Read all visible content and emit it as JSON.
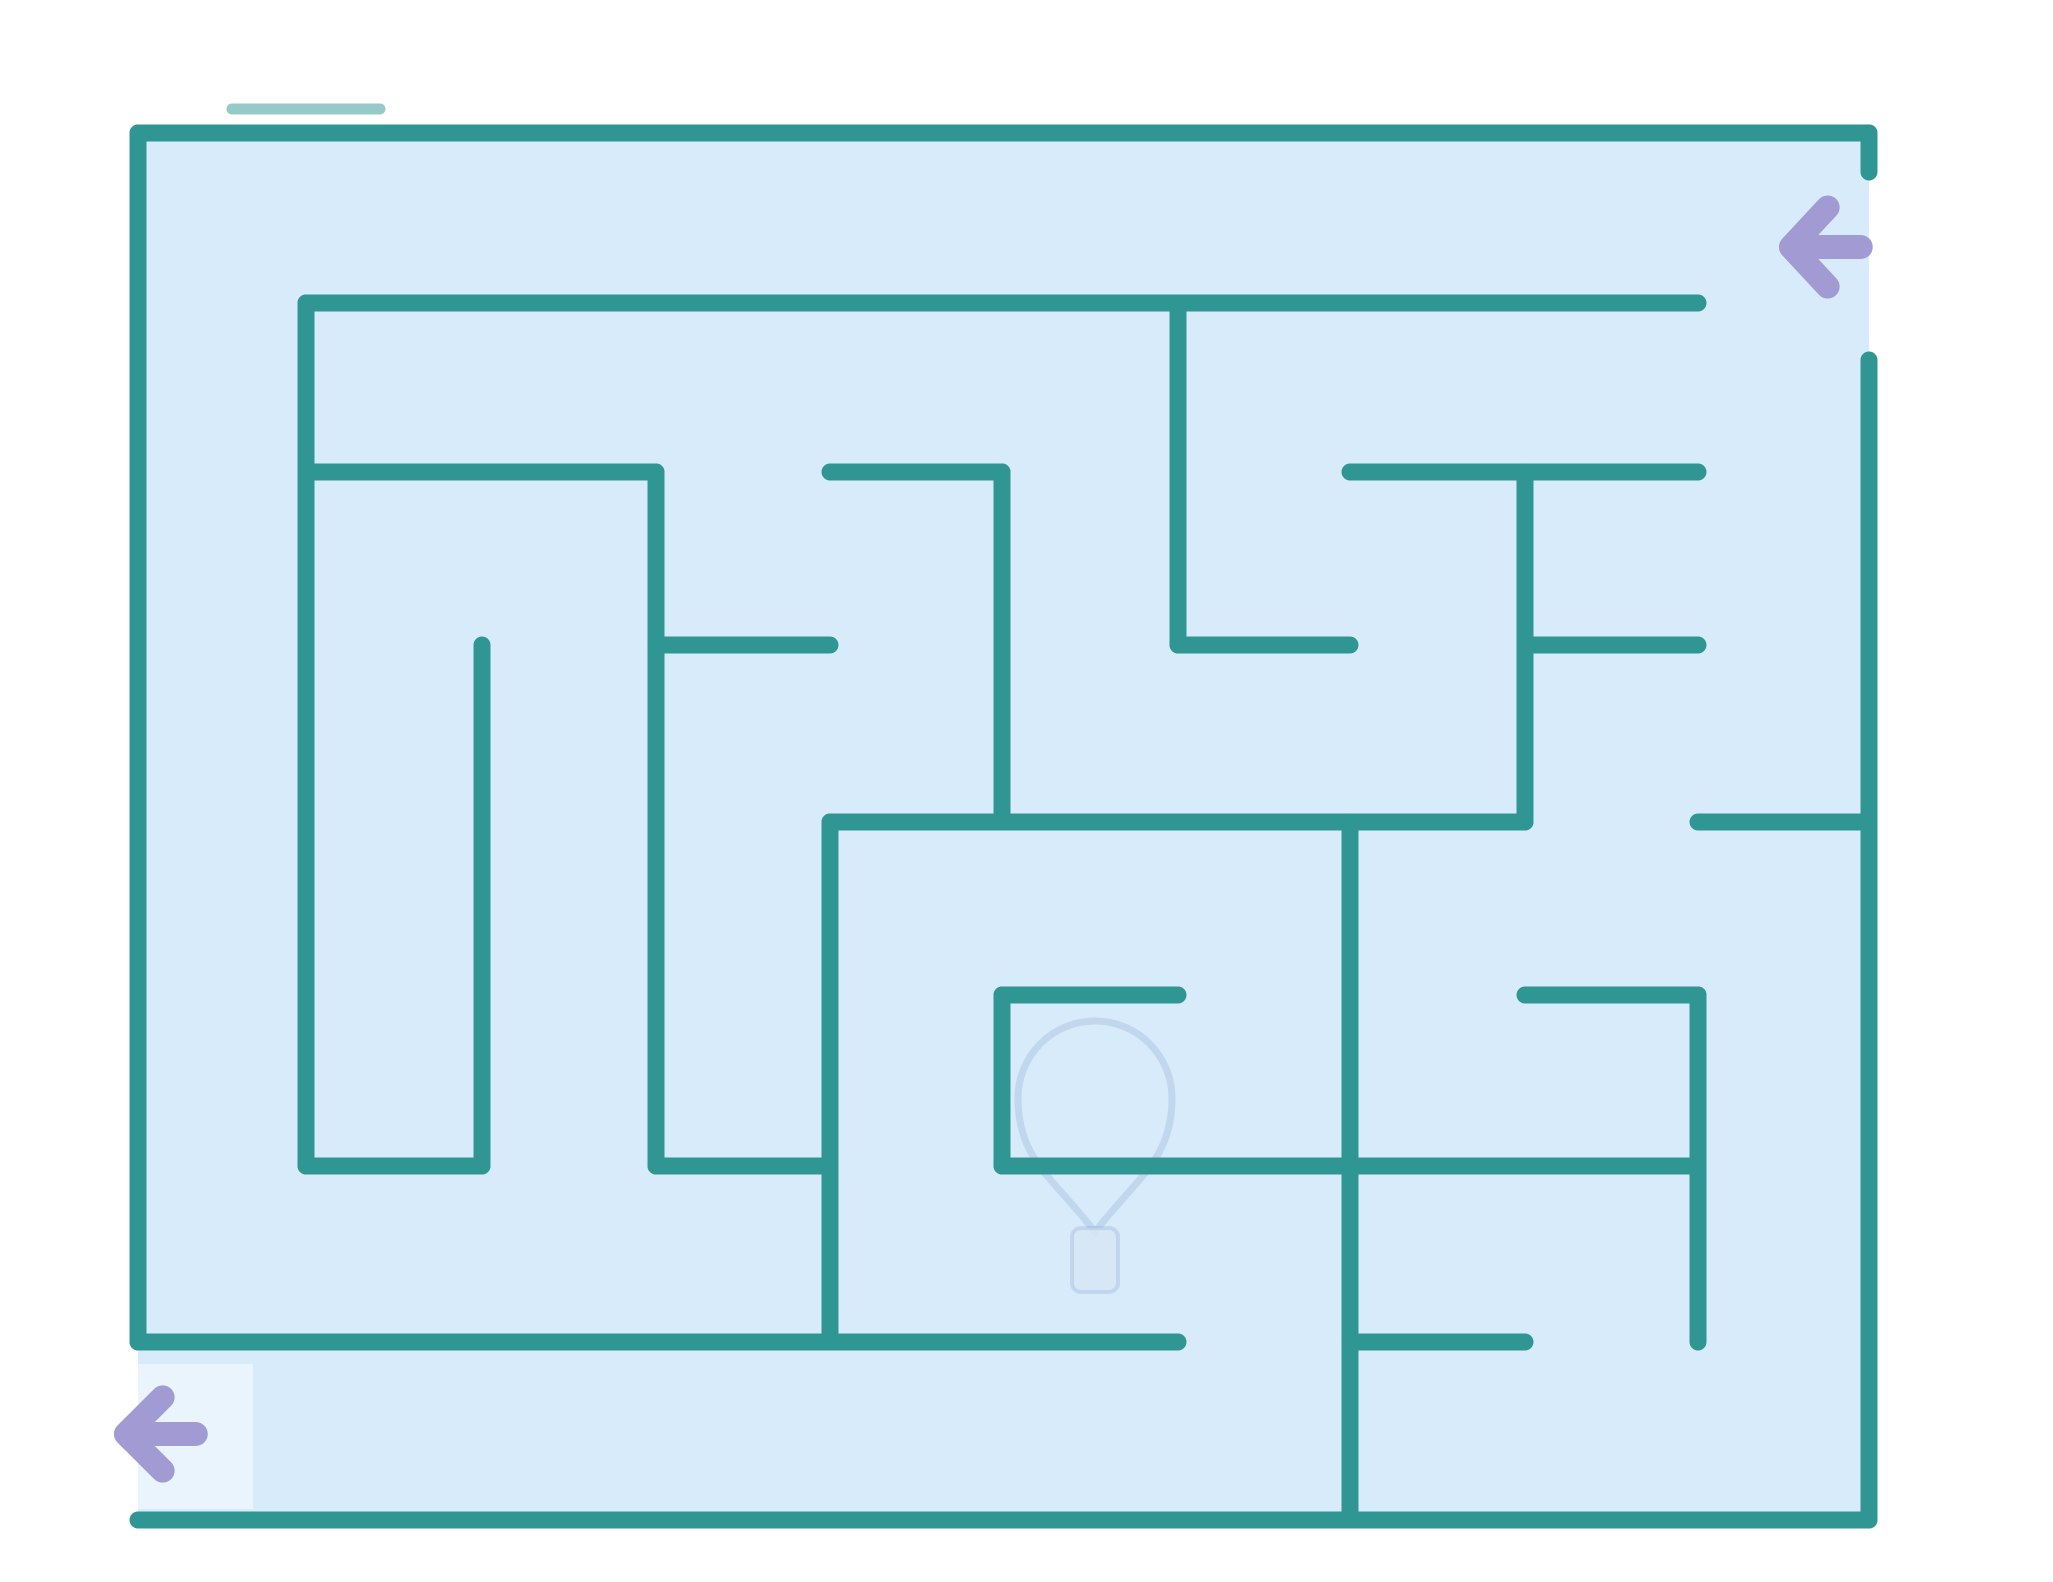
{
  "canvas": {
    "width": 2053,
    "height": 1582,
    "outside_color": "#ffffff"
  },
  "maze": {
    "fill_color": "#d7ebfa",
    "wall_color": "#2f9694",
    "wall_width": 17,
    "bounds": {
      "left": 138,
      "top": 133,
      "right": 1869,
      "bottom": 1520
    },
    "entrance": {
      "side": "right",
      "gap_top": 172,
      "gap_bottom": 360
    },
    "exit": {
      "side": "left",
      "gap_top": 1342,
      "gap_bottom": 1513
    },
    "outer_walls": [
      [
        138,
        133,
        1869,
        133
      ],
      [
        138,
        133,
        138,
        1342
      ],
      [
        138,
        1520,
        1869,
        1520
      ],
      [
        1869,
        133,
        1869,
        172
      ],
      [
        1869,
        360,
        1869,
        1520
      ]
    ],
    "inner_walls": [
      [
        306,
        303,
        1698,
        303
      ],
      [
        306,
        303,
        306,
        1166
      ],
      [
        306,
        1166,
        482,
        1166
      ],
      [
        482,
        645,
        482,
        1166
      ],
      [
        306,
        472,
        656,
        472
      ],
      [
        656,
        472,
        656,
        1166
      ],
      [
        656,
        1166,
        830,
        1166
      ],
      [
        830,
        822,
        830,
        1342
      ],
      [
        830,
        472,
        1002,
        472
      ],
      [
        1002,
        472,
        1002,
        822
      ],
      [
        830,
        822,
        1525,
        822
      ],
      [
        1178,
        303,
        1178,
        645
      ],
      [
        656,
        645,
        830,
        645
      ],
      [
        1178,
        645,
        1350,
        645
      ],
      [
        1002,
        995,
        1178,
        995
      ],
      [
        1002,
        995,
        1002,
        1166
      ],
      [
        1002,
        1166,
        1698,
        1166
      ],
      [
        1350,
        822,
        1350,
        1520
      ],
      [
        138,
        1342,
        1178,
        1342
      ],
      [
        1350,
        1342,
        1525,
        1342
      ],
      [
        1350,
        472,
        1698,
        472
      ],
      [
        1525,
        472,
        1525,
        822
      ],
      [
        1525,
        645,
        1698,
        645
      ],
      [
        1698,
        822,
        1869,
        822
      ],
      [
        1525,
        995,
        1698,
        995
      ],
      [
        1698,
        995,
        1698,
        1342
      ]
    ],
    "sketch_artifact": {
      "x1": 232,
      "y1": 109,
      "x2": 380,
      "y2": 109,
      "opacity": 0.5,
      "width": 11
    }
  },
  "arrows": {
    "color": "#a29bd3",
    "stroke_width": 26,
    "items": [
      {
        "id": "entrance-arrow",
        "direction": "left",
        "x": 1778,
        "y": 192,
        "w": 92,
        "h": 110
      },
      {
        "id": "exit-arrow",
        "direction": "left",
        "x": 113,
        "y": 1383,
        "w": 92,
        "h": 102
      }
    ]
  },
  "watermark": {
    "type": "balloon-pin",
    "center_x": 1095,
    "bubble_center_y": 1098,
    "bubble_radius": 77,
    "tip_y": 1232,
    "stem": {
      "x": 1072,
      "y": 1228,
      "w": 46,
      "h": 64,
      "rx": 9
    },
    "outline_color": "rgba(140,168,208,0.30)",
    "stem_fill": "rgba(216,230,245,0.85)"
  },
  "patches": [
    {
      "x": 78,
      "y": 1364,
      "w": 175,
      "h": 145,
      "fill": "rgba(255,255,255,0.45)"
    }
  ]
}
